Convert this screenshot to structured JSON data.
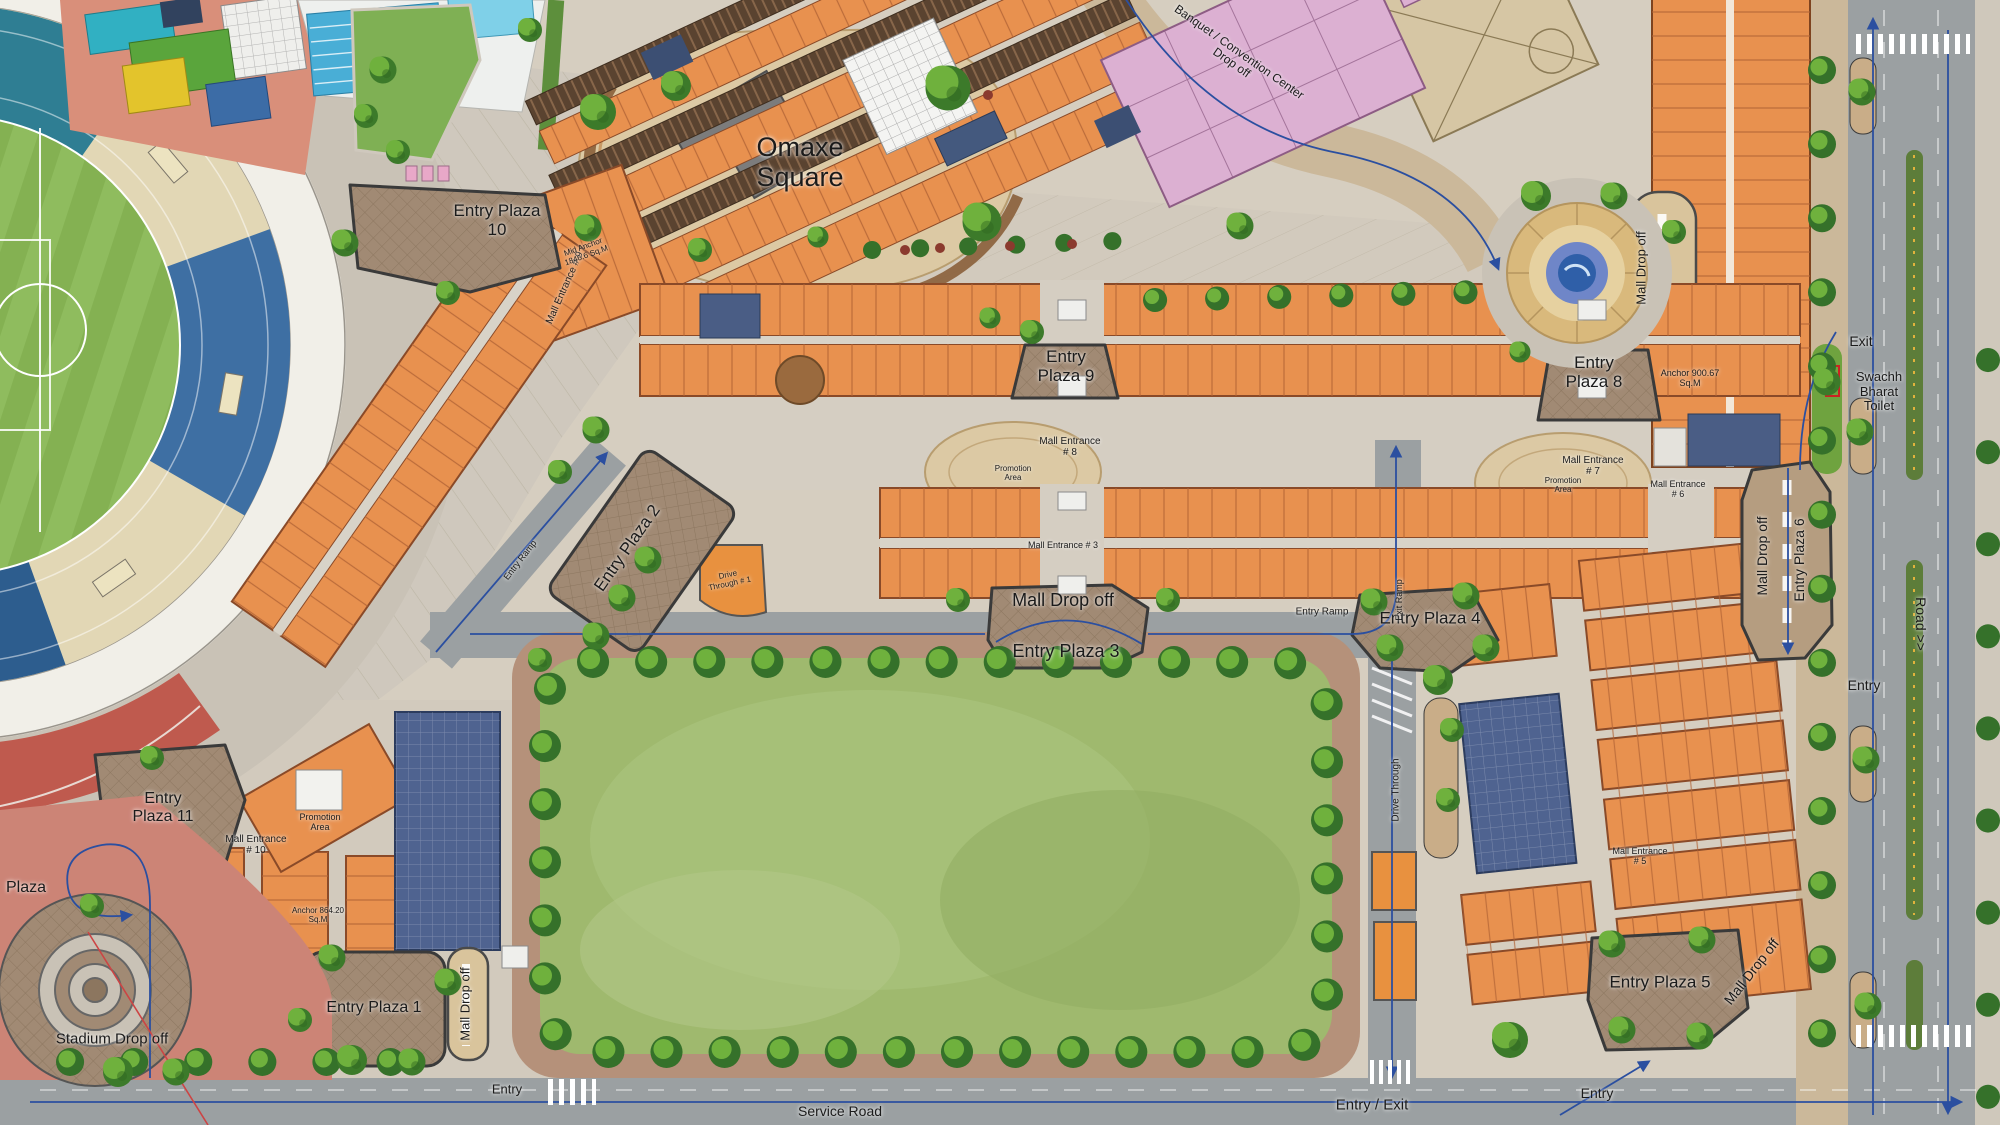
{
  "title": "Omaxe Square Site Plan",
  "landmark": {
    "square": "Omaxe Square",
    "plaza": "Plaza"
  },
  "plazas": {
    "p1": "Entry Plaza 1",
    "p2": "Entry Plaza 2",
    "p3": "Entry Plaza 3",
    "p4": "Entry Plaza 4",
    "p5": "Entry Plaza 5",
    "p6": "Entry Plaza 6",
    "p8": "Entry Plaza 8",
    "p9": "Entry Plaza 9",
    "p10": "Entry Plaza 10",
    "p11": "Entry Plaza 11"
  },
  "entrances": {
    "e3": "Mall Entrance # 3",
    "e5": "Mall Entrance # 5",
    "e6": "Mall Entrance # 6",
    "e7": "Mall Entrance # 7",
    "e8": "Mall Entrance # 8",
    "e9": "Mall Entrance # 9",
    "e10": "Mall Entrance # 10"
  },
  "dropoffs": {
    "mall": "Mall Drop off",
    "stadium": "Stadium Drop off",
    "banquet": "Banquet / Convention Center Drop off"
  },
  "roads": {
    "service": "Service Road",
    "road": "Road >>",
    "entry": "Entry",
    "exit": "Exit",
    "entry_exit": "Entry / Exit",
    "entry_ramp": "Entry Ramp",
    "exit_ramp": "Exit Ramp",
    "drive_through": "Drive Through",
    "drive_through_1": "Drive Through # 1"
  },
  "facilities": {
    "toilet": "Swachh Bharat Toilet",
    "promotion": "Promotion Area",
    "anchor_e": "Anchor 900.67 Sq.M",
    "anchor_sw": "Anchor 864.20 Sq.M",
    "mid_anchor": "Mid Anchor 1846.6 Sq.M"
  },
  "colors": {
    "retail": "#E8914F",
    "roof": "#5A4330",
    "park": "#9FB96E",
    "road": "#9BA0A2",
    "cobble": "#A18A74",
    "water": "#3F7FC1",
    "route_line": "#2B4FA0",
    "stands_blue": "#3E6FA3",
    "pink_block": "#DCB0D2",
    "pitch": "#84B152"
  }
}
